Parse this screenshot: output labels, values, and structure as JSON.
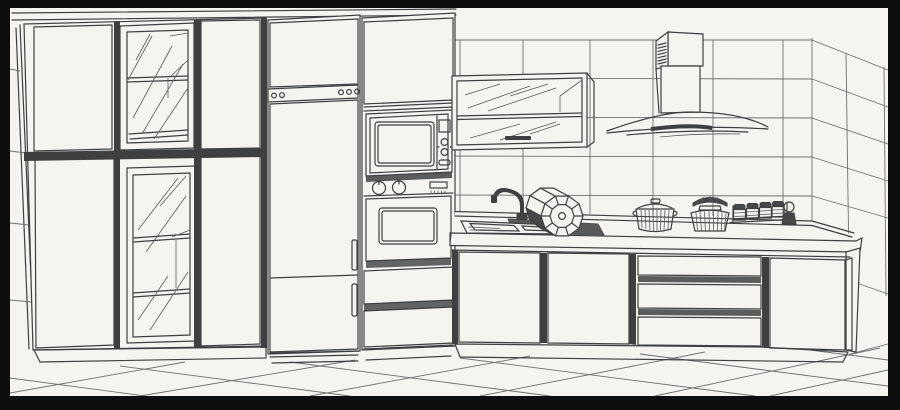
{
  "palette": {
    "frame": "#0d0d0d",
    "paper": "#f5f4f1",
    "ink": "#3f3f3f",
    "ink_light": "#6f6f6f",
    "glass_line": "#5a5a5a",
    "shade": "#474747"
  },
  "objects": [
    {
      "id": "frame",
      "label": "black scan border"
    },
    {
      "id": "cornice",
      "label": "cabinet cornice line"
    },
    {
      "id": "back-wall",
      "label": "tiled back wall"
    },
    {
      "id": "right-wall",
      "label": "tiled right wall corner"
    },
    {
      "id": "left-wall",
      "label": "left wall edge"
    },
    {
      "id": "tall-cabinet-bank",
      "label": "tall cabinet bank with glass display doors"
    },
    {
      "id": "pantry-unit",
      "label": "tall pantry unit with hinge strip and handles"
    },
    {
      "id": "appliance-tower",
      "label": "built-in microwave and oven tower with drawers"
    },
    {
      "id": "wall-glass-cabinet",
      "label": "wall cabinet with horizontal glass flip doors"
    },
    {
      "id": "range-hood",
      "label": "chimney range hood with curved glass canopy"
    },
    {
      "id": "countertop",
      "label": "countertop with back rail"
    },
    {
      "id": "sink",
      "label": "inset sink bowl"
    },
    {
      "id": "faucet",
      "label": "gooseneck faucet"
    },
    {
      "id": "dish-drum",
      "label": "faceted bowl lying on counter"
    },
    {
      "id": "cookware",
      "label": "lidded pot and fluted canister"
    },
    {
      "id": "spice-rack",
      "label": "rack with small spice jars"
    },
    {
      "id": "base-cabinets",
      "label": "base cabinet doors and drawer stack"
    },
    {
      "id": "floor",
      "label": "diagonal floor tiles"
    }
  ]
}
